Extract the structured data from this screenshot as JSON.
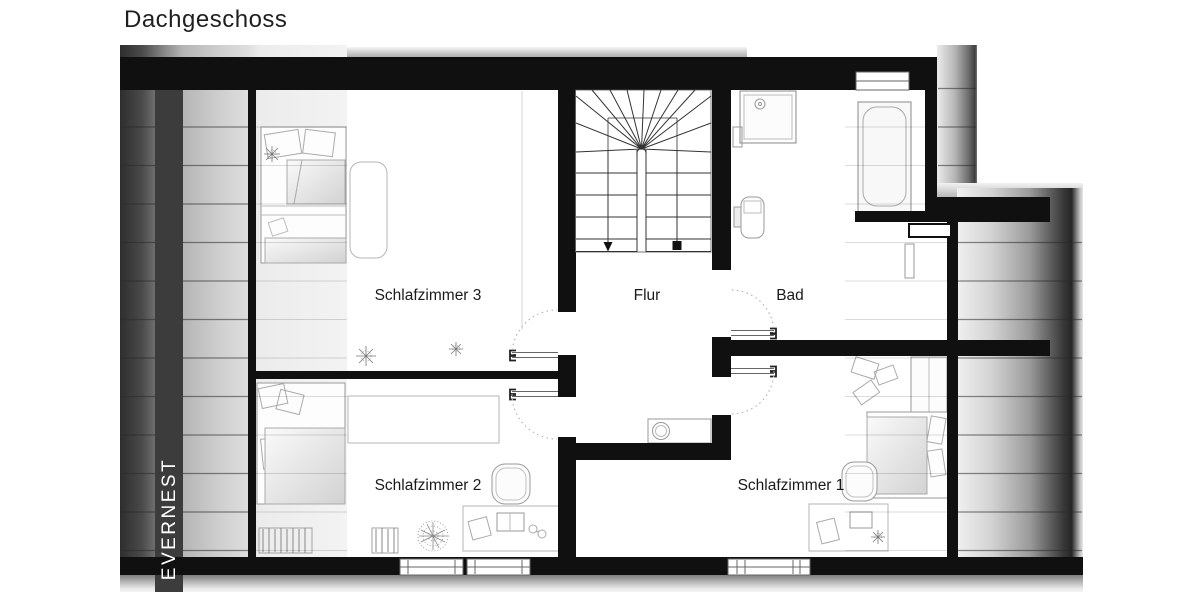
{
  "title": "Dachgeschoss",
  "watermark": "EVERNEST",
  "rooms": [
    {
      "id": "schlafzimmer-3",
      "label": "Schlafzimmer 3"
    },
    {
      "id": "flur",
      "label": "Flur"
    },
    {
      "id": "bad",
      "label": "Bad"
    },
    {
      "id": "schlafzimmer-2",
      "label": "Schlafzimmer 2"
    },
    {
      "id": "schlafzimmer-1",
      "label": "Schlafzimmer 1"
    }
  ],
  "symbols": {
    "stairs": "u-shaped-staircase-with-winders-down-arrow",
    "bad": [
      "shower",
      "toilet",
      "bathtub",
      "window"
    ],
    "flur": [
      "washbasin-cabinet",
      "door-swings"
    ],
    "schlafzimmer_3": [
      "double-bed",
      "armchair",
      "plants"
    ],
    "schlafzimmer_2": [
      "bed",
      "sideboard",
      "desk",
      "chair",
      "radiators",
      "plant",
      "windows"
    ],
    "schlafzimmer_1": [
      "bed",
      "wardrobe",
      "desk",
      "chair",
      "plant",
      "window"
    ]
  },
  "colors": {
    "wall": "#101010",
    "watermark_band": "#3c3c3c",
    "roof_shade_dark": "#2e2e2e",
    "roof_shade_light": "#f3f3f3",
    "furniture_line": "#999999",
    "door_arc": "#b0b0b0",
    "label_text": "#1a1a1a"
  }
}
